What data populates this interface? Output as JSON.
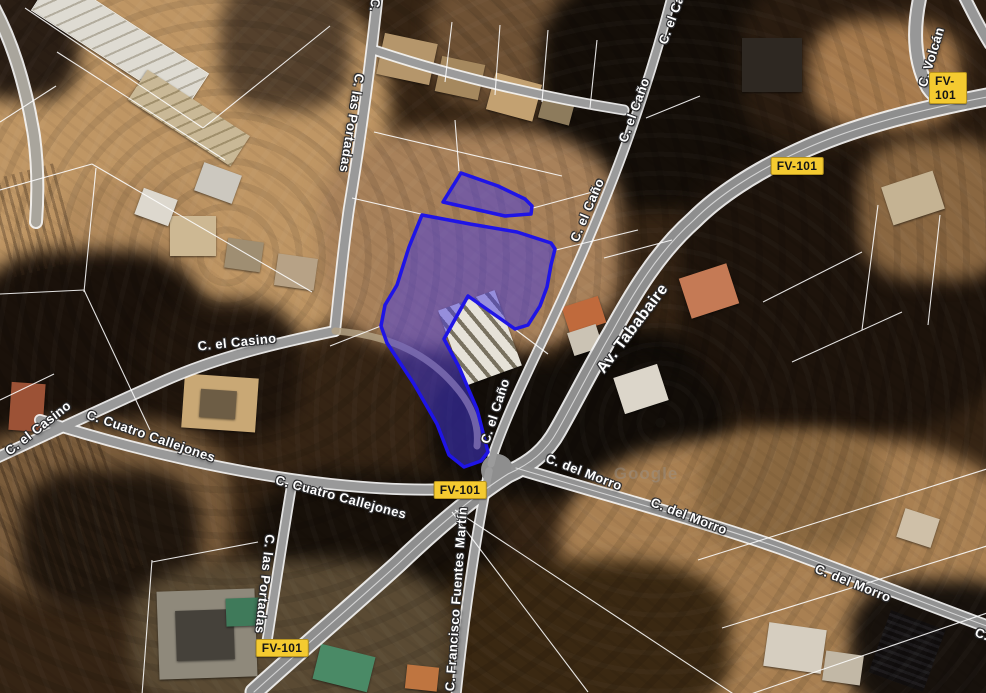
{
  "map": {
    "view_type": "satellite",
    "watermark": "Google",
    "route_badge_label": "FV-101",
    "colors": {
      "parcel_fill": "rgba(70,58,224,0.5)",
      "parcel_stroke": "#1f14e6",
      "route_badge_bg": "#f4ca30"
    },
    "road_labels": [
      {
        "text": "C. las Portadas"
      },
      {
        "text": "C."
      },
      {
        "text": "C. el Caño"
      },
      {
        "text": "C. el Caño"
      },
      {
        "text": "C. el Caño"
      },
      {
        "text": "C. el Caño"
      },
      {
        "text": "Av. Tababaire"
      },
      {
        "text": "C. Volcán"
      },
      {
        "text": "C. el Casino"
      },
      {
        "text": "C. el Casino"
      },
      {
        "text": "C. Cuatro Callejones"
      },
      {
        "text": "C. Cuatro Callejones"
      },
      {
        "text": "C. del Morro"
      },
      {
        "text": "C. del Morro"
      },
      {
        "text": "C. del Morro"
      },
      {
        "text": "C. Francisco Fuentes Martín"
      },
      {
        "text": "C. las Portadas"
      },
      {
        "text": "C."
      }
    ]
  }
}
